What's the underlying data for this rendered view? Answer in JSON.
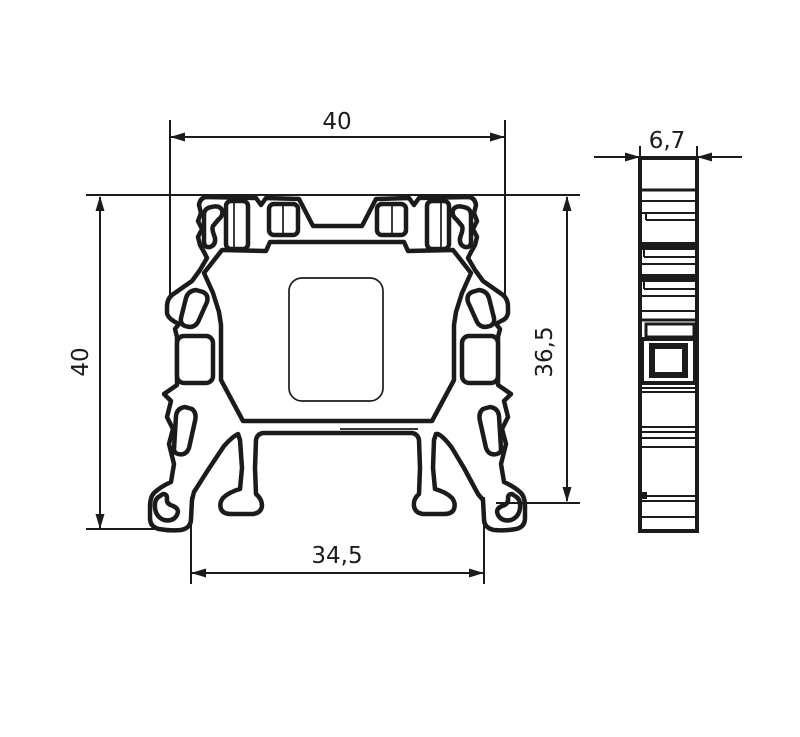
{
  "drawing": {
    "type": "technical-dimension-drawing",
    "subject": "terminal-block-profile",
    "front_view": {
      "dim_top_width": "40",
      "dim_left_height": "40",
      "dim_right_height": "36,5",
      "dim_bottom_width": "34,5"
    },
    "side_view": {
      "dim_width": "6,7"
    },
    "colors": {
      "line": "#1b1b1b",
      "background": "#ffffff"
    }
  }
}
